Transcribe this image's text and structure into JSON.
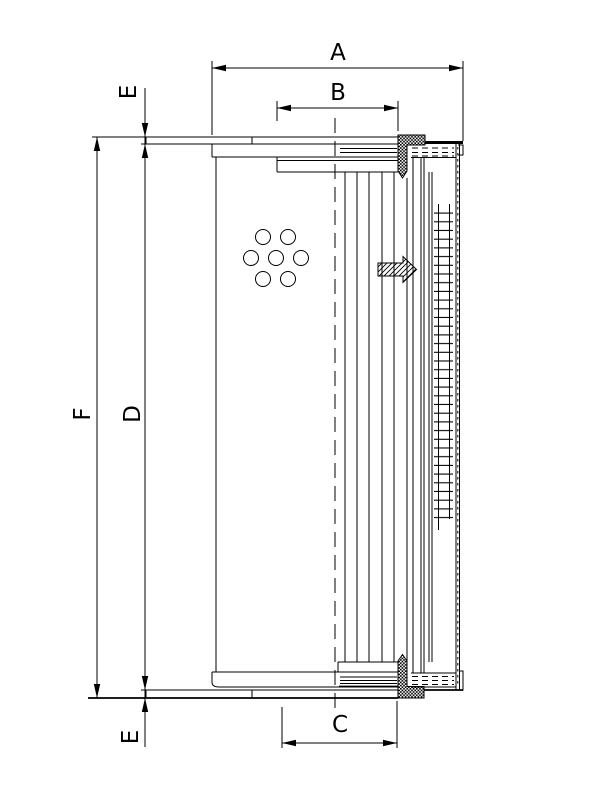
{
  "drawing": {
    "type": "technical-drawing",
    "subject": "filter-element-half-section",
    "colors": {
      "ink": "#000000",
      "paper": "#ffffff"
    },
    "icons": {
      "flow_arrow": "block-arrow-right-hatched",
      "seal": "knurled-seal-block",
      "mesh": "wire-mesh-ladder"
    },
    "labels": {
      "a": "A",
      "b": "B",
      "c": "C",
      "d": "D",
      "f": "F",
      "e_top": "E",
      "e_bottom": "E"
    }
  }
}
